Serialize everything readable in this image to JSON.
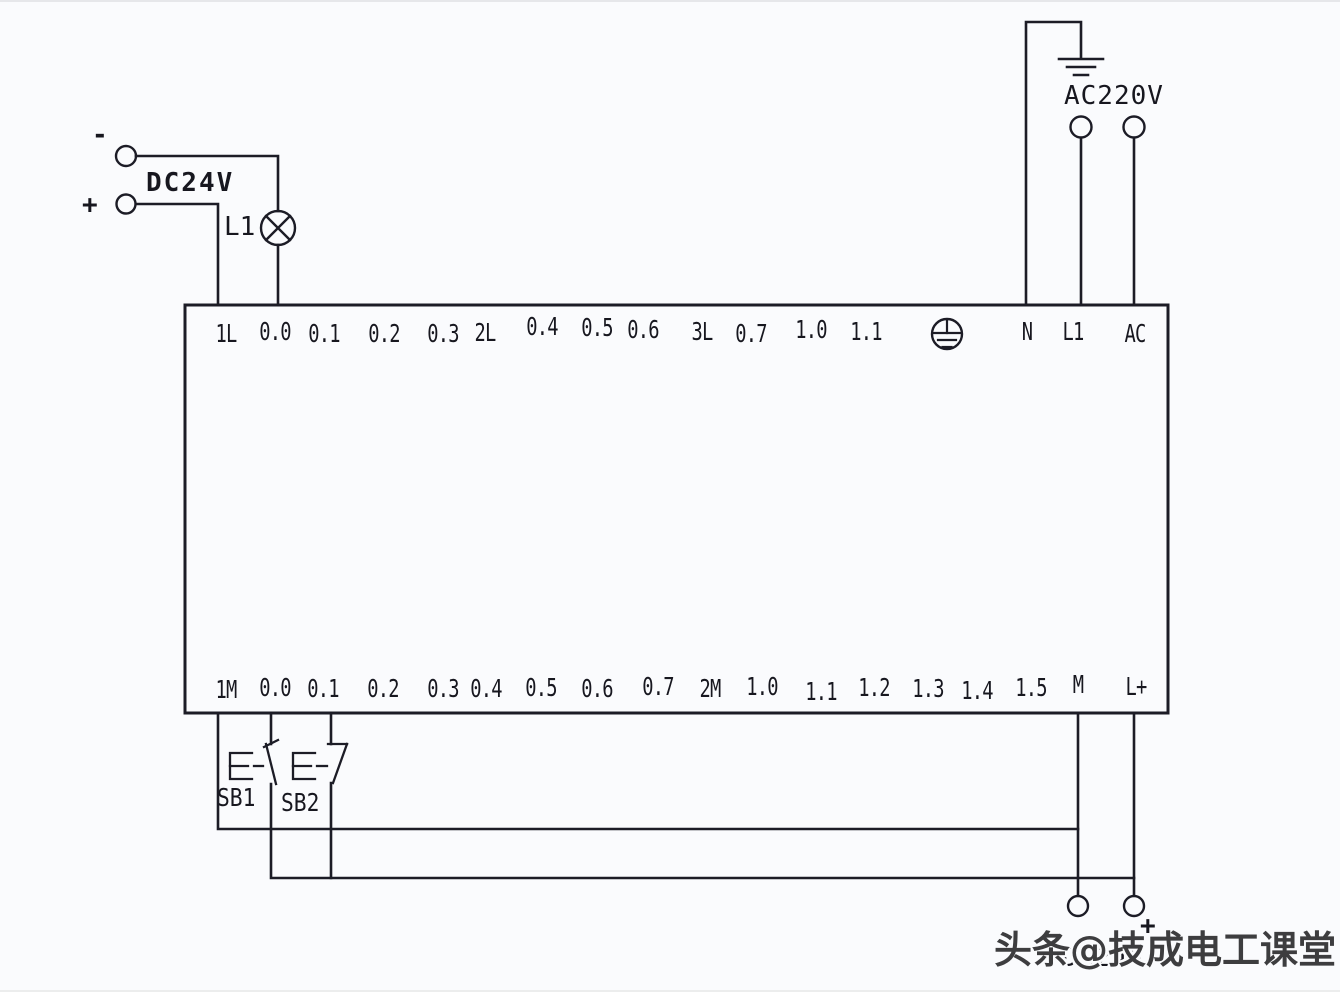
{
  "page": {
    "background": "#fafbfd",
    "line_color": "#1c1c26",
    "text_color": "#17171f"
  },
  "watermark": {
    "text": "头条@技成电工课堂",
    "color": "#3d3d3f"
  },
  "top_left_supply": {
    "label": "DC24V",
    "minus": "-",
    "plus": "+"
  },
  "lamp": {
    "label": "L1",
    "icon": "lamp-icon"
  },
  "top_right_supply": {
    "label": "AC220V",
    "icon": "earth-ground-icon"
  },
  "bottom_supply": {
    "label": "DC24V",
    "plus": "+"
  },
  "buttons": [
    {
      "label": "SB1",
      "icon": "pushbutton-no-icon"
    },
    {
      "label": "SB2",
      "icon": "pushbutton-nc-icon"
    }
  ],
  "plc": {
    "pe_icon": {
      "name": "protective-earth-icon",
      "x": 948
    },
    "top_terminals": [
      {
        "label": "1L",
        "x": 226,
        "dy": 2
      },
      {
        "label": "0.0",
        "x": 275,
        "dy": 0
      },
      {
        "label": "0.1",
        "x": 324,
        "dy": 2
      },
      {
        "label": "0.2",
        "x": 384,
        "dy": 2
      },
      {
        "label": "0.3",
        "x": 443,
        "dy": 2
      },
      {
        "label": "2L",
        "x": 485,
        "dy": 1
      },
      {
        "label": "0.4",
        "x": 542,
        "dy": -5
      },
      {
        "label": "0.5",
        "x": 597,
        "dy": -4
      },
      {
        "label": "0.6",
        "x": 643,
        "dy": -2
      },
      {
        "label": "3L",
        "x": 702,
        "dy": 0
      },
      {
        "label": "0.7",
        "x": 751,
        "dy": 2
      },
      {
        "label": "1.0",
        "x": 811,
        "dy": -2
      },
      {
        "label": "1.1",
        "x": 866,
        "dy": 0
      },
      {
        "label": "N",
        "x": 1027,
        "dy": 0
      },
      {
        "label": "L1",
        "x": 1073,
        "dy": 0
      },
      {
        "label": "AC",
        "x": 1135,
        "dy": 2
      }
    ],
    "bottom_terminals": [
      {
        "label": "1M",
        "x": 226,
        "dy": 1
      },
      {
        "label": "0.0",
        "x": 275,
        "dy": -1
      },
      {
        "label": "0.1",
        "x": 323,
        "dy": 0
      },
      {
        "label": "0.2",
        "x": 383,
        "dy": 0
      },
      {
        "label": "0.3",
        "x": 443,
        "dy": 0
      },
      {
        "label": "0.4",
        "x": 486,
        "dy": 0
      },
      {
        "label": "0.5",
        "x": 541,
        "dy": -1
      },
      {
        "label": "0.6",
        "x": 597,
        "dy": 0
      },
      {
        "label": "0.7",
        "x": 658,
        "dy": -2
      },
      {
        "label": "2M",
        "x": 710,
        "dy": 0
      },
      {
        "label": "1.0",
        "x": 762,
        "dy": -2
      },
      {
        "label": "1.1",
        "x": 821,
        "dy": 3
      },
      {
        "label": "1.2",
        "x": 874,
        "dy": -1
      },
      {
        "label": "1.3",
        "x": 928,
        "dy": 0
      },
      {
        "label": "1.4",
        "x": 977,
        "dy": 2
      },
      {
        "label": "1.5",
        "x": 1031,
        "dy": -1
      },
      {
        "label": "M",
        "x": 1078,
        "dy": -4
      },
      {
        "label": "L+",
        "x": 1136,
        "dy": -2
      }
    ]
  }
}
